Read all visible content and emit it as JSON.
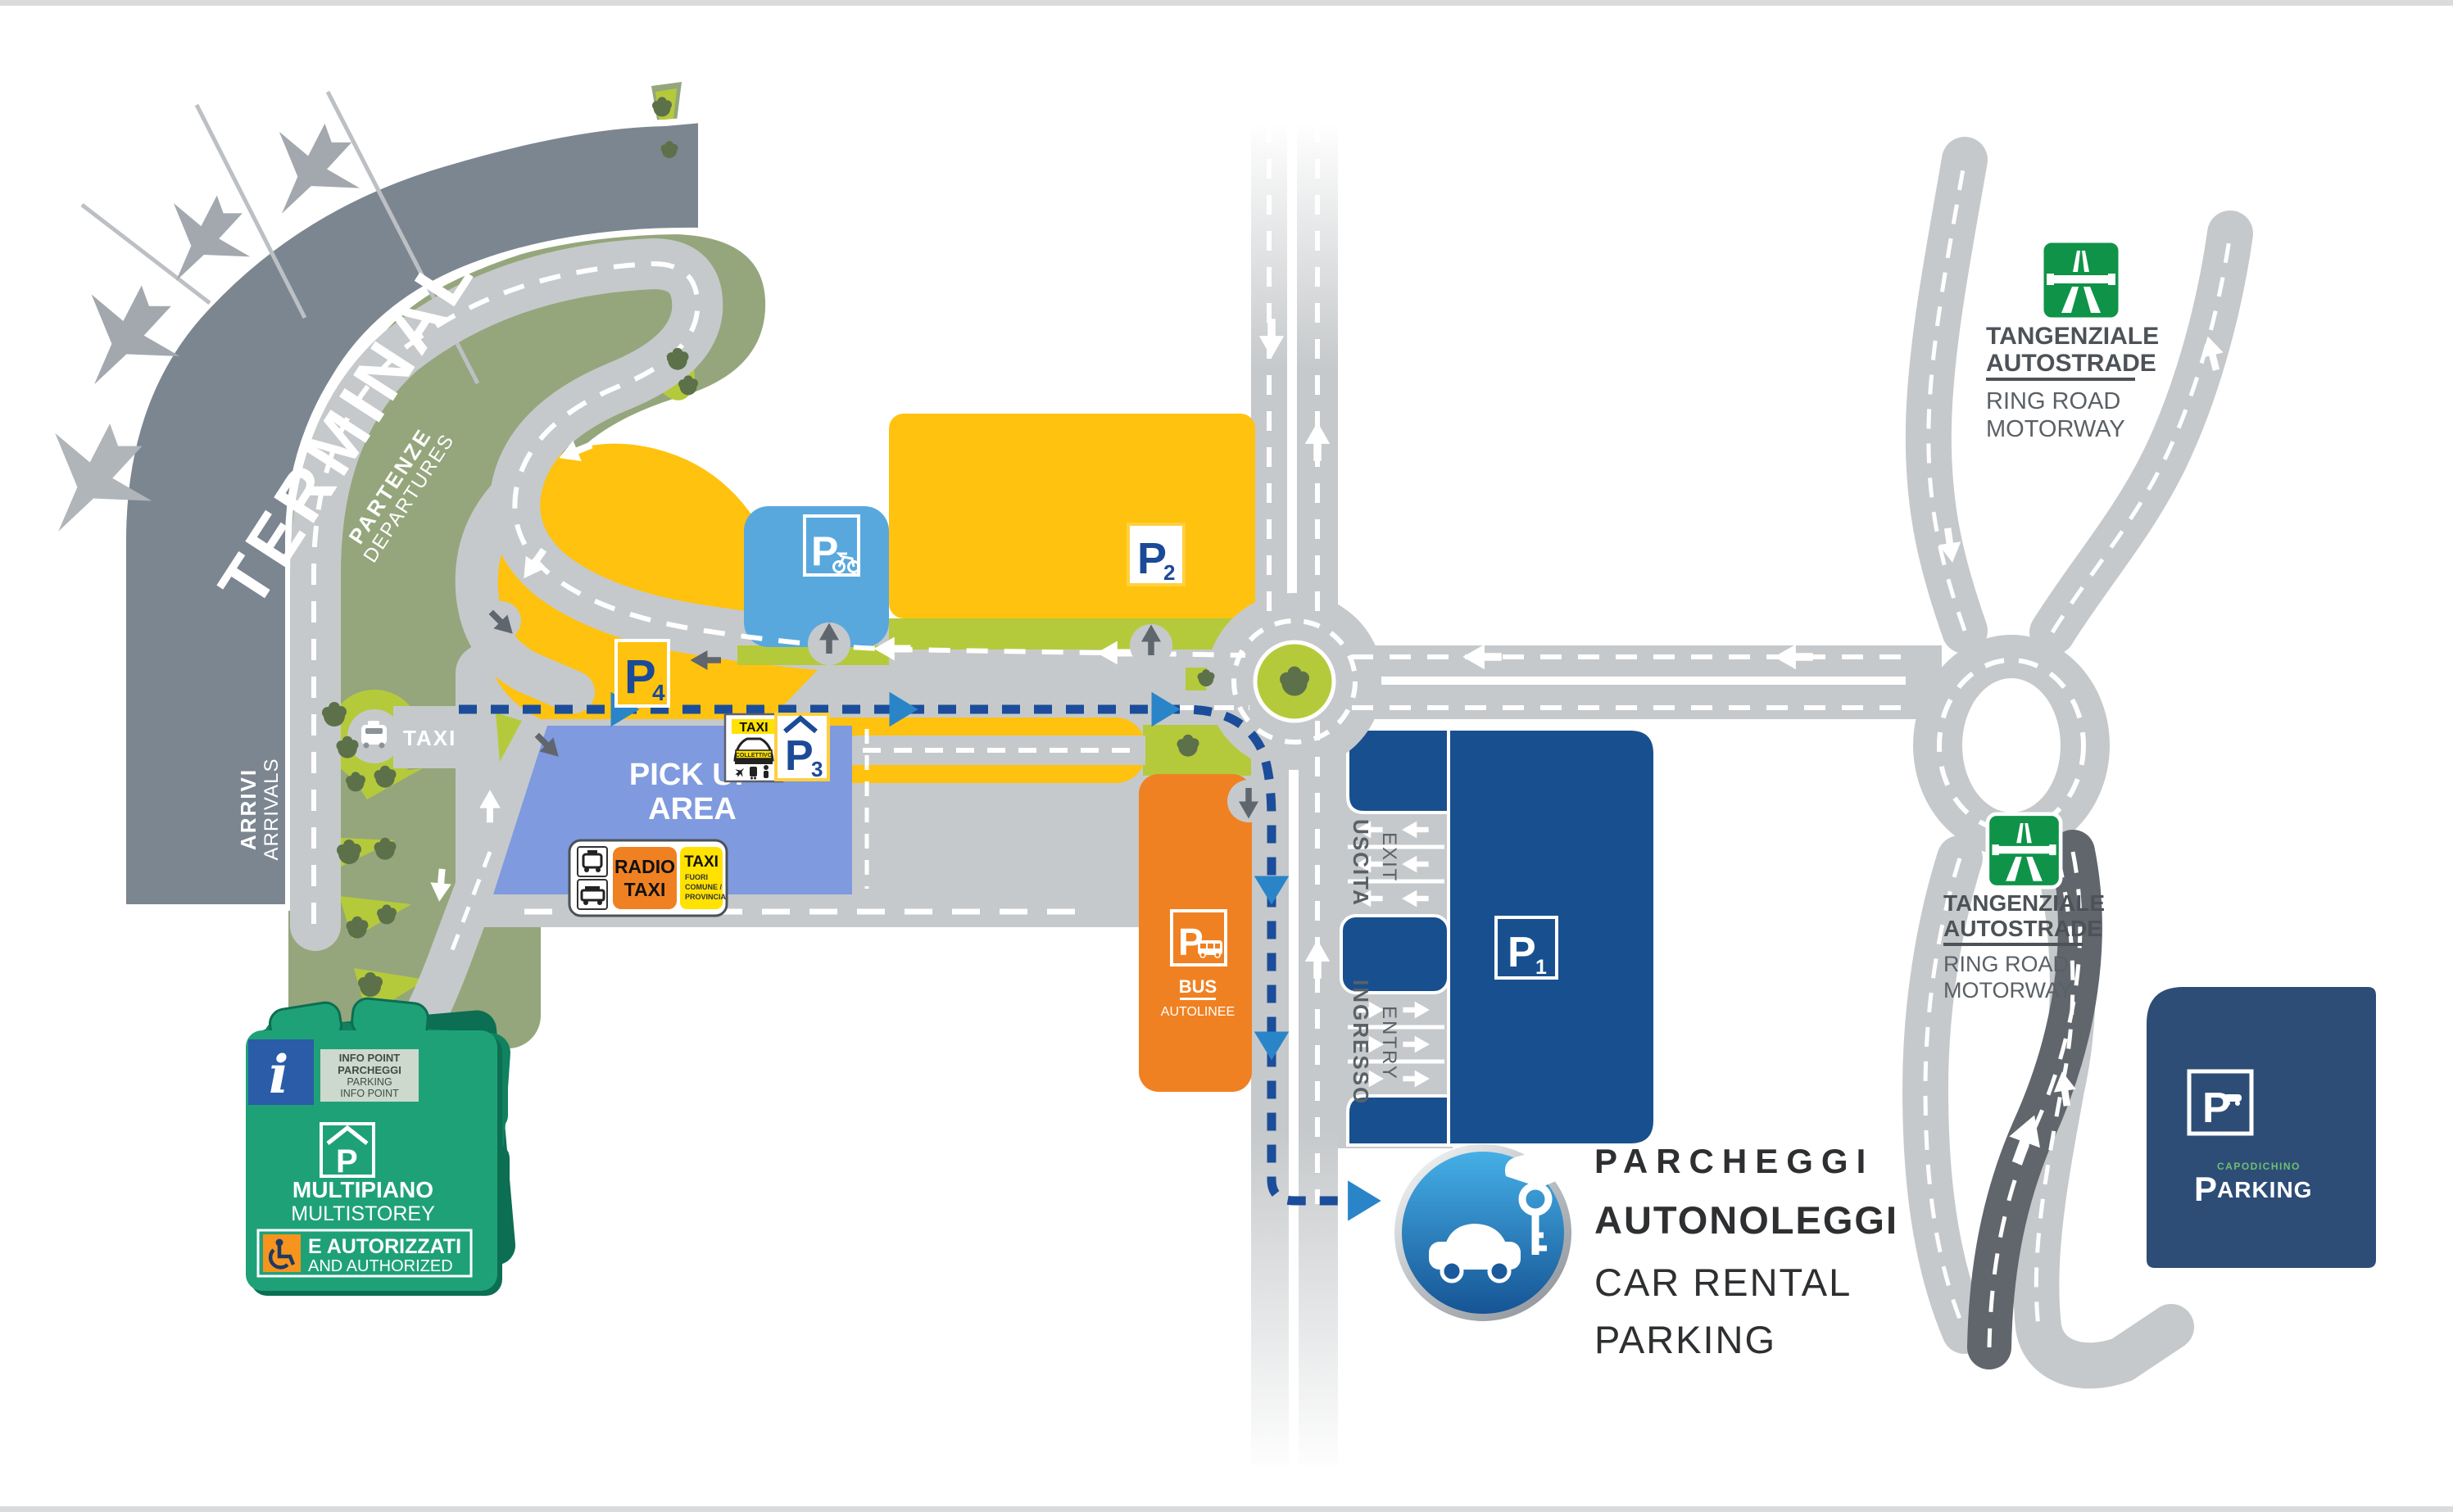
{
  "colors": {
    "road_gray": "#c6c9cb",
    "terminal_gray": "#7c8691",
    "sage_green": "#95a67c",
    "bright_green": "#b5ca3b",
    "tree_green": "#5c7149",
    "parking_yellow": "#ffc20e",
    "pickup_blue": "#7f9adf",
    "bike_blue": "#58a8de",
    "p1_blue": "#18508f",
    "navy": "#2d4d77",
    "bus_orange": "#f08122",
    "route_blue": "#1b4d9a",
    "route_arrow_blue": "#2a85c8",
    "sign_teal_green": "#1fa178",
    "autostrada_green": "#0f9348",
    "label_gray": "#5a6167"
  },
  "terminal": {
    "title": "TERMINAL",
    "partenze": "PARTENZE",
    "departures": "DEPARTURES",
    "arrivi": "ARRIVI",
    "arrivals": "ARRIVALS"
  },
  "landside": {
    "taxi_label": "TAXI",
    "pickup_line1": "PICK UP",
    "pickup_line2": "AREA"
  },
  "parking": {
    "p1": {
      "letter": "P",
      "digit": "1"
    },
    "p2": {
      "letter": "P",
      "digit": "2"
    },
    "p3": {
      "letter": "P",
      "digit": "3"
    },
    "p4": {
      "letter": "P",
      "digit": "4"
    },
    "bike": {
      "letter": "P"
    },
    "bus": {
      "letter": "P",
      "title": "BUS",
      "subtitle": "AUTOLINEE"
    },
    "multistorey": {
      "info_icon": "i",
      "info_line1": "INFO POINT",
      "info_line2": "PARCHEGGI",
      "info_line3": "PARKING",
      "info_line4": "INFO POINT",
      "icon_letter": "P",
      "title_it": "MULTIPIANO",
      "title_en": "MULTISTOREY",
      "authorized_it": "E AUTORIZZATI",
      "authorized_en": "AND AUTHORIZED"
    },
    "capodichino": {
      "sign_letter": "P",
      "brand_top": "CAPODICHINO",
      "brand_p": "P",
      "brand_rest": "ARKING"
    }
  },
  "taxi_signs": {
    "collettivo": {
      "header": "TAXI",
      "band": "COLLETTIVO"
    },
    "radio": {
      "line1": "RADIO",
      "line2": "TAXI"
    },
    "extra": {
      "header": "TAXI",
      "line1": "FUORI",
      "line2": "COMUNE /",
      "line3": "PROVINCIA"
    }
  },
  "traffic": {
    "uscita": "USCITA",
    "exit": "EXIT",
    "ingresso": "INGRESSO",
    "entry": "ENTRY"
  },
  "motorway_sign_top": {
    "line1": "TANGENZIALE",
    "line2": "AUTOSTRADE",
    "line3": "RING ROAD",
    "line4": "MOTORWAY"
  },
  "motorway_sign_bottom": {
    "line1": "TANGENZIALE",
    "line2": "AUTOSTRADE",
    "line3": "RING ROAD",
    "line4": "MOTORWAY"
  },
  "legend": {
    "line1": "PARCHEGGI",
    "line2": "AUTONOLEGGI",
    "line3": "CAR RENTAL",
    "line4": "PARKING"
  }
}
